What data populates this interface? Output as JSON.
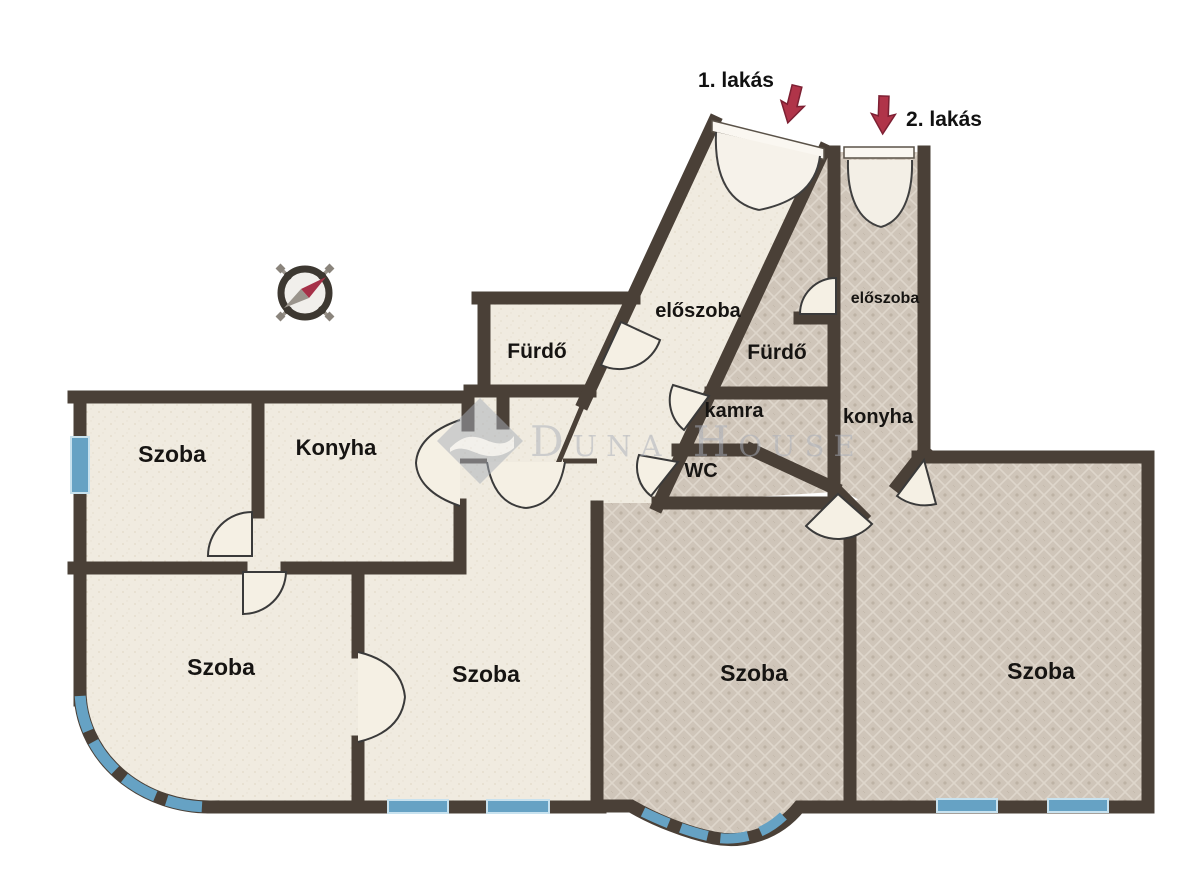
{
  "plan": {
    "title": "Two-flat floor plan",
    "apartment1": {
      "tag": "1. lakás",
      "rooms": [
        {
          "name": "szoba-top-left",
          "label": "Szoba"
        },
        {
          "name": "konyha",
          "label": "Konyha"
        },
        {
          "name": "furdo",
          "label": "Fürdő"
        },
        {
          "name": "eloszoba",
          "label": "előszoba"
        },
        {
          "name": "szoba-bottom-left",
          "label": "Szoba"
        },
        {
          "name": "szoba-bottom-middle",
          "label": "Szoba"
        }
      ]
    },
    "apartment2": {
      "tag": "2. lakás",
      "rooms": [
        {
          "name": "eloszoba",
          "label": "előszoba"
        },
        {
          "name": "furdo",
          "label": "Fürdő"
        },
        {
          "name": "kamra",
          "label": "kamra"
        },
        {
          "name": "wc",
          "label": "WC"
        },
        {
          "name": "konyha",
          "label": "konyha"
        },
        {
          "name": "szoba-middle",
          "label": "Szoba"
        },
        {
          "name": "szoba-right",
          "label": "Szoba"
        }
      ]
    },
    "watermark": {
      "text": "Duna House"
    },
    "compass": {
      "needle_direction": "NE"
    },
    "colors": {
      "wall": "#4a4037",
      "floor_light": "#f0ebe0",
      "floor_dark": "#cfc5b9",
      "window_blue": "#66a2c4",
      "arrow_red": "#b03449"
    }
  }
}
